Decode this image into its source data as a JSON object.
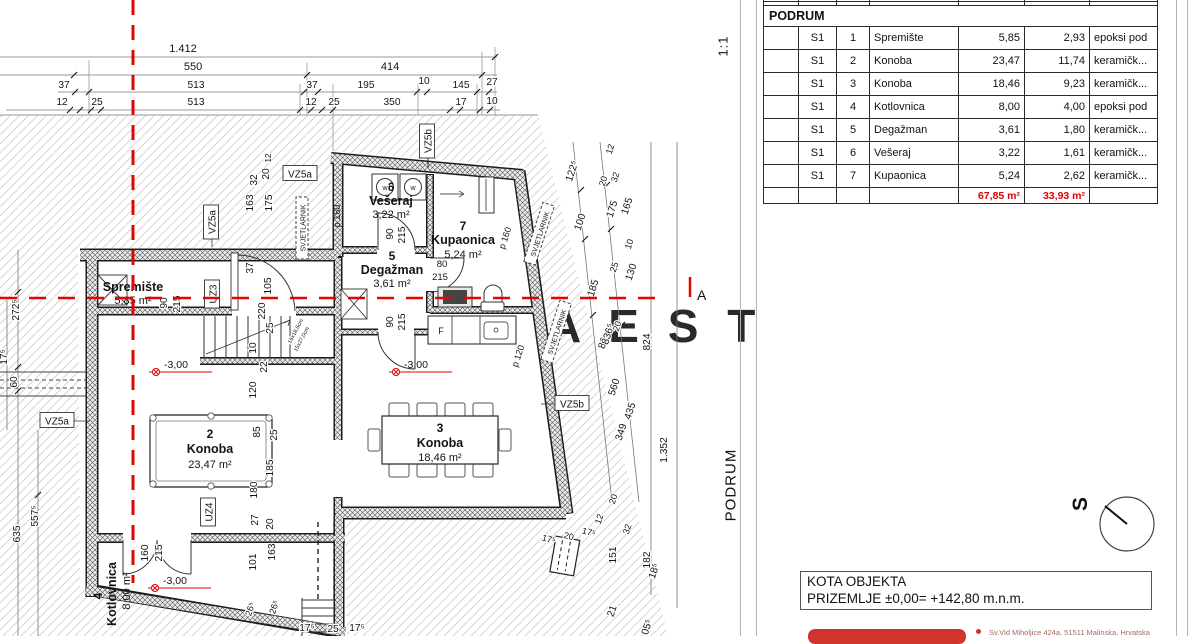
{
  "scale": {
    "label": "1:1"
  },
  "side_title": "PODRUM",
  "watermark": "A E S T A T E",
  "section_marker": "A",
  "table": {
    "title": "PODRUM",
    "rows": [
      {
        "unit": "S1",
        "num": "1",
        "name": "Spremište",
        "area": "5,85",
        "half": "2,93",
        "floor": "epoksi pod"
      },
      {
        "unit": "S1",
        "num": "2",
        "name": "Konoba",
        "area": "23,47",
        "half": "11,74",
        "floor": "keramičk..."
      },
      {
        "unit": "S1",
        "num": "3",
        "name": "Konoba",
        "area": "18,46",
        "half": "9,23",
        "floor": "keramičk..."
      },
      {
        "unit": "S1",
        "num": "4",
        "name": "Kotlovnica",
        "area": "8,00",
        "half": "4,00",
        "floor": "epoksi pod"
      },
      {
        "unit": "S1",
        "num": "5",
        "name": "Degažman",
        "area": "3,61",
        "half": "1,80",
        "floor": "keramičk..."
      },
      {
        "unit": "S1",
        "num": "6",
        "name": "Vešeraj",
        "area": "3,22",
        "half": "1,61",
        "floor": "keramičk..."
      },
      {
        "unit": "S1",
        "num": "7",
        "name": "Kupaonica",
        "area": "5,24",
        "half": "2,62",
        "floor": "keramičk..."
      }
    ],
    "totals": {
      "area": "67,85 m²",
      "half": "33,93 m²"
    }
  },
  "kota": {
    "line1": "KOTA OBJEKTA",
    "line2": "PRIZEMLJE ±0,00= +142,80 m.n.m."
  },
  "compass": {
    "letter": "S"
  },
  "footer": {
    "address": "Sv.Vid Miholjice 424a, 51511 Malinska, Hrvatska"
  },
  "plan": {
    "rooms": [
      {
        "number": "",
        "name": "Spremište",
        "area": "5,85 m²"
      },
      {
        "number": "2",
        "name": "Konoba",
        "area": "23,47 m²"
      },
      {
        "number": "3",
        "name": "Konoba",
        "area": "18,46 m²"
      },
      {
        "number": "4",
        "name": "Kotlovnica",
        "area": "8,00 m²"
      },
      {
        "number": "5",
        "name": "Degažman",
        "area": "3,61 m²"
      },
      {
        "number": "6",
        "name": "Vešeraj",
        "area": "3,22 m²"
      },
      {
        "number": "7",
        "name": "Kupaonica",
        "area": "5,24 m²"
      }
    ],
    "fridge": "F",
    "elevation": {
      "label": "-3,00",
      "points": [
        {
          "x": 152,
          "y": 366
        },
        {
          "x": 392,
          "y": 366
        },
        {
          "x": 151,
          "y": 582
        }
      ]
    },
    "tags": [
      {
        "t": "VZ5a",
        "x": 57,
        "y": 421,
        "r": 0,
        "w": 34,
        "box": "solid"
      },
      {
        "t": "VZ5a",
        "x": 212,
        "y": 222,
        "r": -90,
        "w": 34,
        "box": "solid"
      },
      {
        "t": "VZ5a",
        "x": 300,
        "y": 174,
        "r": 0,
        "w": 34,
        "box": "solid"
      },
      {
        "t": "VZ5b",
        "x": 428,
        "y": 141,
        "r": -90,
        "w": 34,
        "box": "solid"
      },
      {
        "t": "VZ5b",
        "x": 572,
        "y": 404,
        "r": 0,
        "w": 34,
        "box": "solid"
      },
      {
        "t": "UZ3",
        "x": 213,
        "y": 294,
        "r": -90,
        "w": 28,
        "box": "solid"
      },
      {
        "t": "UZ4",
        "x": 209,
        "y": 512,
        "r": -90,
        "w": 28,
        "box": "solid"
      },
      {
        "t": "SVJETLARNIK",
        "x": 303,
        "y": 228,
        "r": -90,
        "w": 62,
        "fs": 7,
        "box": "dash"
      },
      {
        "t": "SVJETLARNIK",
        "x": 540,
        "y": 234,
        "r": -72,
        "w": 62,
        "fs": 7,
        "box": "dash"
      },
      {
        "t": "SVJETLARNIK",
        "x": 557,
        "y": 332,
        "r": -72,
        "w": 62,
        "fs": 7,
        "box": "dash"
      },
      {
        "t": "p 160",
        "x": 337,
        "y": 216,
        "r": -90,
        "fs": 9,
        "box": "none"
      },
      {
        "t": "p 160",
        "x": 505,
        "y": 238,
        "r": -72,
        "fs": 9,
        "box": "none"
      },
      {
        "t": "p 120",
        "x": 518,
        "y": 356,
        "r": -72,
        "fs": 9,
        "box": "none"
      }
    ],
    "dims": [
      {
        "t": "1.412",
        "x": 183,
        "y": 52,
        "r": 0,
        "fs": 11
      },
      {
        "t": "550",
        "x": 193,
        "y": 70,
        "r": 0,
        "fs": 11
      },
      {
        "t": "414",
        "x": 390,
        "y": 70,
        "r": 0,
        "fs": 11
      },
      {
        "t": "37",
        "x": 64,
        "y": 88,
        "r": 0
      },
      {
        "t": "513",
        "x": 196,
        "y": 88,
        "r": 0
      },
      {
        "t": "37",
        "x": 312,
        "y": 88,
        "r": 0
      },
      {
        "t": "195",
        "x": 366,
        "y": 88,
        "r": 0
      },
      {
        "t": "10",
        "x": 424,
        "y": 84,
        "r": 0
      },
      {
        "t": "145",
        "x": 461,
        "y": 88,
        "r": 0
      },
      {
        "t": "27",
        "x": 492,
        "y": 85,
        "r": 0
      },
      {
        "t": "12",
        "x": 62,
        "y": 105,
        "r": 0
      },
      {
        "t": "25",
        "x": 97,
        "y": 105,
        "r": 0
      },
      {
        "t": "513",
        "x": 196,
        "y": 105,
        "r": 0
      },
      {
        "t": "12",
        "x": 311,
        "y": 105,
        "r": 0
      },
      {
        "t": "25",
        "x": 334,
        "y": 105,
        "r": 0
      },
      {
        "t": "350",
        "x": 392,
        "y": 105,
        "r": 0
      },
      {
        "t": "17",
        "x": 461,
        "y": 105,
        "r": 0
      },
      {
        "t": "10",
        "x": 492,
        "y": 104,
        "r": 0
      },
      {
        "t": "272⁵",
        "x": 19,
        "y": 310,
        "r": -90
      },
      {
        "t": "60",
        "x": 17,
        "y": 382,
        "r": -90
      },
      {
        "t": "17⁵",
        "x": 7,
        "y": 357,
        "r": -90
      },
      {
        "t": "557⁵",
        "x": 38,
        "y": 516,
        "r": -90
      },
      {
        "t": "635",
        "x": 20,
        "y": 534,
        "r": -90
      },
      {
        "t": "163",
        "x": 253,
        "y": 203,
        "r": -90
      },
      {
        "t": "32",
        "x": 257,
        "y": 180,
        "r": -90
      },
      {
        "t": "20",
        "x": 269,
        "y": 174,
        "r": -90
      },
      {
        "t": "175",
        "x": 272,
        "y": 203,
        "r": -90
      },
      {
        "t": "12",
        "x": 271,
        "y": 158,
        "r": -90,
        "fs": 8
      },
      {
        "t": "37",
        "x": 253,
        "y": 268,
        "r": -90
      },
      {
        "t": "105",
        "x": 271,
        "y": 286,
        "r": -90
      },
      {
        "t": "100",
        "x": 308,
        "y": 210,
        "r": -90,
        "fs": 9
      },
      {
        "t": "60",
        "x": 308,
        "y": 223,
        "r": -90,
        "fs": 9
      },
      {
        "t": "220",
        "x": 265,
        "y": 311,
        "r": -90
      },
      {
        "t": "25",
        "x": 273,
        "y": 328,
        "r": -90
      },
      {
        "t": "10",
        "x": 256,
        "y": 348,
        "r": -90
      },
      {
        "t": "22",
        "x": 267,
        "y": 367,
        "r": -90
      },
      {
        "t": "120",
        "x": 256,
        "y": 390,
        "r": -90
      },
      {
        "t": "90",
        "x": 167,
        "y": 303,
        "r": -90
      },
      {
        "t": "215",
        "x": 180,
        "y": 304,
        "r": -90
      },
      {
        "t": "90",
        "x": 393,
        "y": 234,
        "r": -90
      },
      {
        "t": "215",
        "x": 405,
        "y": 235,
        "r": -90
      },
      {
        "t": "90",
        "x": 393,
        "y": 322,
        "r": -90
      },
      {
        "t": "215",
        "x": 405,
        "y": 322,
        "r": -90
      },
      {
        "t": "160",
        "x": 148,
        "y": 553,
        "r": -90
      },
      {
        "t": "215",
        "x": 162,
        "y": 553,
        "r": -90
      },
      {
        "t": "101",
        "x": 256,
        "y": 562,
        "r": -90
      },
      {
        "t": "163",
        "x": 275,
        "y": 552,
        "r": -90
      },
      {
        "t": "27",
        "x": 258,
        "y": 520,
        "r": -90
      },
      {
        "t": "20",
        "x": 273,
        "y": 524,
        "r": -90
      },
      {
        "t": "85",
        "x": 260,
        "y": 432,
        "r": -90
      },
      {
        "t": "25",
        "x": 277,
        "y": 435,
        "r": -90
      },
      {
        "t": "185",
        "x": 273,
        "y": 468,
        "r": -90
      },
      {
        "t": "180",
        "x": 257,
        "y": 490,
        "r": -90
      },
      {
        "t": "824",
        "x": 650,
        "y": 342,
        "r": -90
      },
      {
        "t": "1.352",
        "x": 667,
        "y": 450,
        "r": -90
      },
      {
        "t": "151",
        "x": 616,
        "y": 555,
        "r": -90
      },
      {
        "t": "182",
        "x": 650,
        "y": 560,
        "r": -90
      },
      {
        "t": "80",
        "x": 442,
        "y": 267,
        "r": 0,
        "fs": 9.5
      },
      {
        "t": "215",
        "x": 440,
        "y": 280,
        "r": 0,
        "fs": 9.5
      },
      {
        "t": "17⁵",
        "x": 307,
        "y": 631,
        "r": 0
      },
      {
        "t": "25",
        "x": 333,
        "y": 632,
        "r": 0
      },
      {
        "t": "17⁵",
        "x": 357,
        "y": 631,
        "r": 0
      },
      {
        "t": "122⁵",
        "x": 575,
        "y": 172,
        "r": -72
      },
      {
        "t": "100",
        "x": 583,
        "y": 223,
        "r": -72
      },
      {
        "t": "185",
        "x": 596,
        "y": 289,
        "r": -72
      },
      {
        "t": "80",
        "x": 606,
        "y": 344,
        "r": -72
      },
      {
        "t": "560",
        "x": 617,
        "y": 388,
        "r": -72
      },
      {
        "t": "435",
        "x": 633,
        "y": 412,
        "r": -72
      },
      {
        "t": "349",
        "x": 624,
        "y": 433,
        "r": -72
      },
      {
        "t": "12",
        "x": 613,
        "y": 150,
        "r": -72,
        "fs": 9
      },
      {
        "t": "20",
        "x": 606,
        "y": 182,
        "r": -72,
        "fs": 9
      },
      {
        "t": "32",
        "x": 618,
        "y": 178,
        "r": -72,
        "fs": 9
      },
      {
        "t": "175",
        "x": 615,
        "y": 210,
        "r": -72
      },
      {
        "t": "165",
        "x": 630,
        "y": 207,
        "r": -72
      },
      {
        "t": "10",
        "x": 632,
        "y": 245,
        "r": -72,
        "fs": 9
      },
      {
        "t": "25",
        "x": 617,
        "y": 268,
        "r": -72,
        "fs": 9
      },
      {
        "t": "130",
        "x": 634,
        "y": 273,
        "r": -72
      },
      {
        "t": "20",
        "x": 620,
        "y": 327,
        "r": -72,
        "fs": 9
      },
      {
        "t": "836⁵",
        "x": 611,
        "y": 335,
        "r": -72
      },
      {
        "t": "20",
        "x": 616,
        "y": 500,
        "r": -72,
        "fs": 9
      },
      {
        "t": "12",
        "x": 602,
        "y": 520,
        "r": -72,
        "fs": 9
      },
      {
        "t": "32",
        "x": 630,
        "y": 530,
        "r": -72,
        "fs": 9
      },
      {
        "t": "21",
        "x": 615,
        "y": 612,
        "r": -72
      },
      {
        "t": "05⁵",
        "x": 650,
        "y": 628,
        "r": -72
      },
      {
        "t": "18⁵",
        "x": 657,
        "y": 572,
        "r": -72
      },
      {
        "t": "26⁵",
        "x": 253,
        "y": 610,
        "r": -72,
        "fs": 9
      },
      {
        "t": "26⁵",
        "x": 277,
        "y": 608,
        "r": -72,
        "fs": 9
      },
      {
        "t": "17⁵",
        "x": 548,
        "y": 542,
        "r": 15,
        "fs": 9
      },
      {
        "t": "20",
        "x": 568,
        "y": 539,
        "r": 15,
        "fs": 9
      },
      {
        "t": "17⁵",
        "x": 588,
        "y": 535,
        "r": 15,
        "fs": 9
      },
      {
        "t": "w",
        "x": 385,
        "y": 190,
        "r": 0,
        "fs": 7
      },
      {
        "t": "w",
        "x": 413,
        "y": 190,
        "r": 0,
        "fs": 7
      },
      {
        "t": "16x18,6cm",
        "x": 297,
        "y": 332,
        "r": -62,
        "fs": 5.5
      },
      {
        "t": "15x27,0cm",
        "x": 303,
        "y": 340,
        "r": -62,
        "fs": 5.5
      }
    ]
  }
}
